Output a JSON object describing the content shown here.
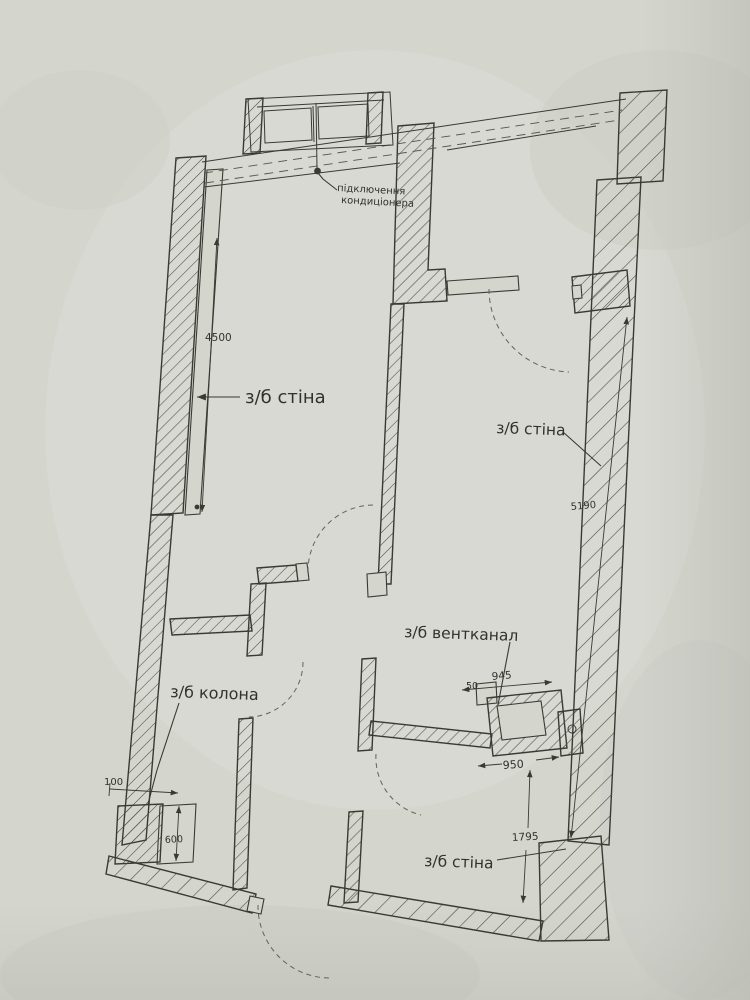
{
  "colors": {
    "paper": "#d4d6ce",
    "ink": "#3a3a33",
    "hatch": "#4b4b43",
    "dashed_lines": "#63635b"
  },
  "labels": {
    "wall_left": "з/б стіна",
    "wall_right": "з/б стіна",
    "wall_bottom": "з/б стіна",
    "column": "з/б колона",
    "vent": "з/б вентканал",
    "ac_connection_line1": "підключення",
    "ac_connection_line2": "кондиціонера"
  },
  "dimensions": {
    "left_wall_length": "4500",
    "right_wall_length": "5190",
    "vent_width_top": "945",
    "vent_offset": "50",
    "vent_width_bottom": "950",
    "column_offset": "100",
    "column_size": "600",
    "hall_depth": "1795"
  }
}
